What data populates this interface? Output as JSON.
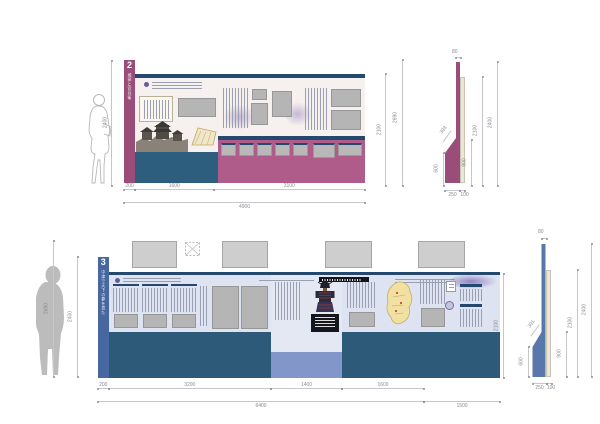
{
  "colors": {
    "maroon_band": "#9a4d78",
    "maroon_base": "#b05c8a",
    "navy": "#24486e",
    "teal_base": "#2d5e7d",
    "blue_band": "#46679f",
    "light_blue_base": "#8296ca",
    "cream_panel": "#f6f1ee",
    "light_panel": "#dde3f0",
    "placeholder_gray": "#b5b5b5",
    "profile_backing": "#ebe6d7"
  },
  "elevation2": {
    "panel_number": "2",
    "vertical_title": "城郭と官兵衛",
    "dims": {
      "left_height": "2400",
      "right_inner": "2100",
      "right_outer": "2690",
      "bottom_seg1": "200",
      "bottom_seg2": "1600",
      "bottom_seg3": "3100",
      "bottom_total": "4900"
    }
  },
  "profile2": {
    "dims": {
      "top_width": "80",
      "total_height": "2400",
      "backing_height": "2100",
      "mid_height": "900",
      "base_height": "600",
      "diagonal": "393",
      "base_depth": "250",
      "backing_depth": "100"
    }
  },
  "elevation3": {
    "panel_number": "3",
    "vertical_title": "中津で天下の夢を見た",
    "dims": {
      "left_outer": "2690",
      "left_inner": "2400",
      "right_inner": "2100",
      "bottom_seg1": "200",
      "bottom_seg2": "3200",
      "bottom_seg3": "1400",
      "bottom_seg4": "1600",
      "bottom_total": "6400",
      "bottom_right": "1500"
    }
  },
  "profile3": {
    "dims": {
      "top_width": "80",
      "total_height": "2400",
      "backing_height": "2100",
      "mid_height": "900",
      "base_height": "600",
      "diagonal": "391",
      "base_depth": "250",
      "backing_depth": "100"
    }
  }
}
